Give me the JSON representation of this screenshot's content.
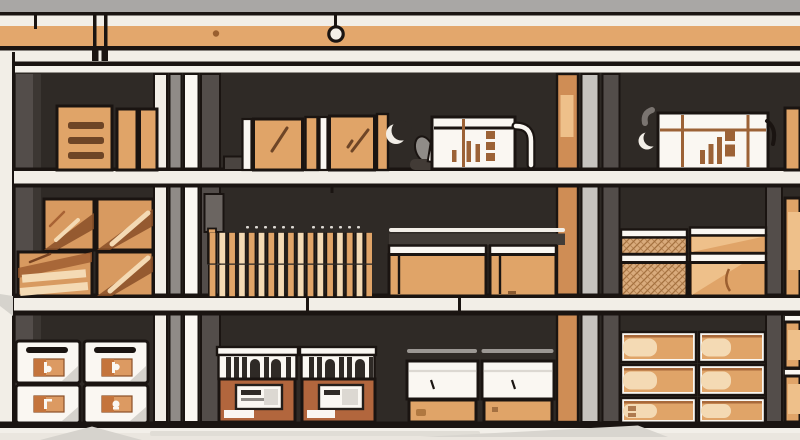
{
  "meta": {
    "type": "flat-vector-illustration",
    "subject": "Warehouse shelving unit with three shelves filled with cartons, wooden crates, lumber slats, bottle crates, mesh bins, labeled drawers and market-stall cabinets",
    "width_px": 800,
    "height_px": 440
  },
  "colors": {
    "ink": "#1a1411",
    "wall": "#a9a7a5",
    "cream": "#f2eee7",
    "white": "#faf7f2",
    "beam": "#e3a76c",
    "interior": "#2f2a26",
    "post": "#534d4a",
    "postdark": "#3c3733",
    "gray": "#8f8b87",
    "lightgray": "#c6c3bf",
    "palegray": "#dcd8d2",
    "tan": "#e0a468",
    "tanlight": "#eec08a",
    "pale": "#f4dab4",
    "brown": "#6e4526",
    "frame": "#9c6236",
    "rust": "#b2663d",
    "wood": "#d89a60",
    "woodstreak": "#8a4f28",
    "label": "#dc9a62",
    "labeldeep": "#c4743c",
    "tanpost": "#cf8d55",
    "floor": "#f2efe9",
    "shadow": "#d6d3cd",
    "scoop": "#908c88",
    "mesh": "#d9ab7c",
    "meshline": "#a4713f"
  },
  "scene": {
    "ceiling": {
      "items": [
        "wall-band",
        "trim-strips",
        "support-beam",
        "mounting-brackets",
        "hanging-ring",
        "wall-plug-dot"
      ]
    },
    "shelves": [
      {
        "name": "top-shelf",
        "items": [
          "lined-carton",
          "slim-cartons",
          "plank-strips",
          "taped-boxes",
          "bottle-crate-middle",
          "bottle-crate-right",
          "pipe-handle",
          "crescent-hooks",
          "edge-carton"
        ]
      },
      {
        "name": "middle-shelf",
        "items": [
          "wooden-crates-2x2",
          "lumber-slat-rows",
          "lidded-bins",
          "mesh-crates",
          "tan-cartons",
          "edge-carton"
        ]
      },
      {
        "name": "bottom-shelf",
        "items": [
          "labeled-drawers-2x2",
          "market-stall-1",
          "market-stall-2",
          "open-bins",
          "carton-grid-2x3",
          "edge-carton-stack"
        ]
      }
    ],
    "counts": {
      "drawers": 4,
      "wooden_crates": 4,
      "market_stalls": 2,
      "open_bins": 2,
      "carton_grid_rows": 3,
      "carton_grid_cols": 2,
      "lumber_slat_rows": 2
    },
    "floor": {
      "shadow_shapes": 3
    }
  }
}
